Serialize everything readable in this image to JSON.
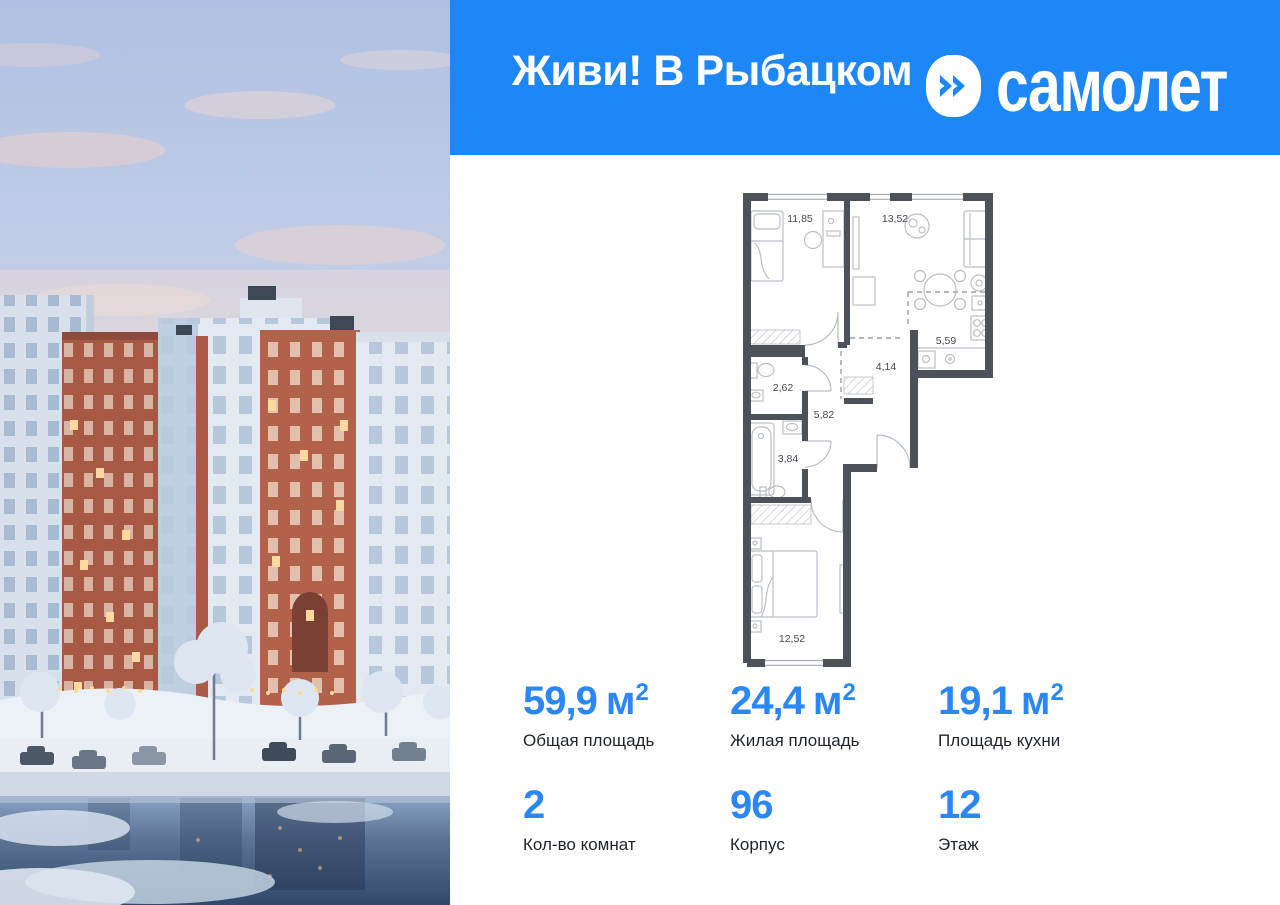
{
  "header": {
    "title": "Живи! В Рыбацком",
    "brand": "самолет"
  },
  "plan": {
    "rooms": [
      {
        "name": "bedroom-1",
        "area": "11,85"
      },
      {
        "name": "living-room",
        "area": "13,52"
      },
      {
        "name": "kitchen",
        "area": "5,59"
      },
      {
        "name": "hallway",
        "area": "4,14"
      },
      {
        "name": "wc",
        "area": "2,62"
      },
      {
        "name": "corridor",
        "area": "5,82"
      },
      {
        "name": "bathroom",
        "area": "3,84"
      },
      {
        "name": "bedroom-2",
        "area": "12,52"
      }
    ]
  },
  "stats": {
    "items": [
      {
        "value": "59,9",
        "unit": "м",
        "sup": "2",
        "label": "Общая площадь"
      },
      {
        "value": "24,4",
        "unit": "м",
        "sup": "2",
        "label": "Жилая площадь"
      },
      {
        "value": "19,1",
        "unit": "м",
        "sup": "2",
        "label": "Площадь кухни"
      },
      {
        "value": "2",
        "unit": "",
        "sup": "",
        "label": "Кол-во комнат"
      },
      {
        "value": "96",
        "unit": "",
        "sup": "",
        "label": "Корпус"
      },
      {
        "value": "12",
        "unit": "",
        "sup": "",
        "label": "Этаж"
      }
    ]
  },
  "colors": {
    "header_bg": "#1e87f8",
    "accent_value": "#2b86f6",
    "text_dark": "#1f242a",
    "plan_wall": "#4d525a"
  }
}
